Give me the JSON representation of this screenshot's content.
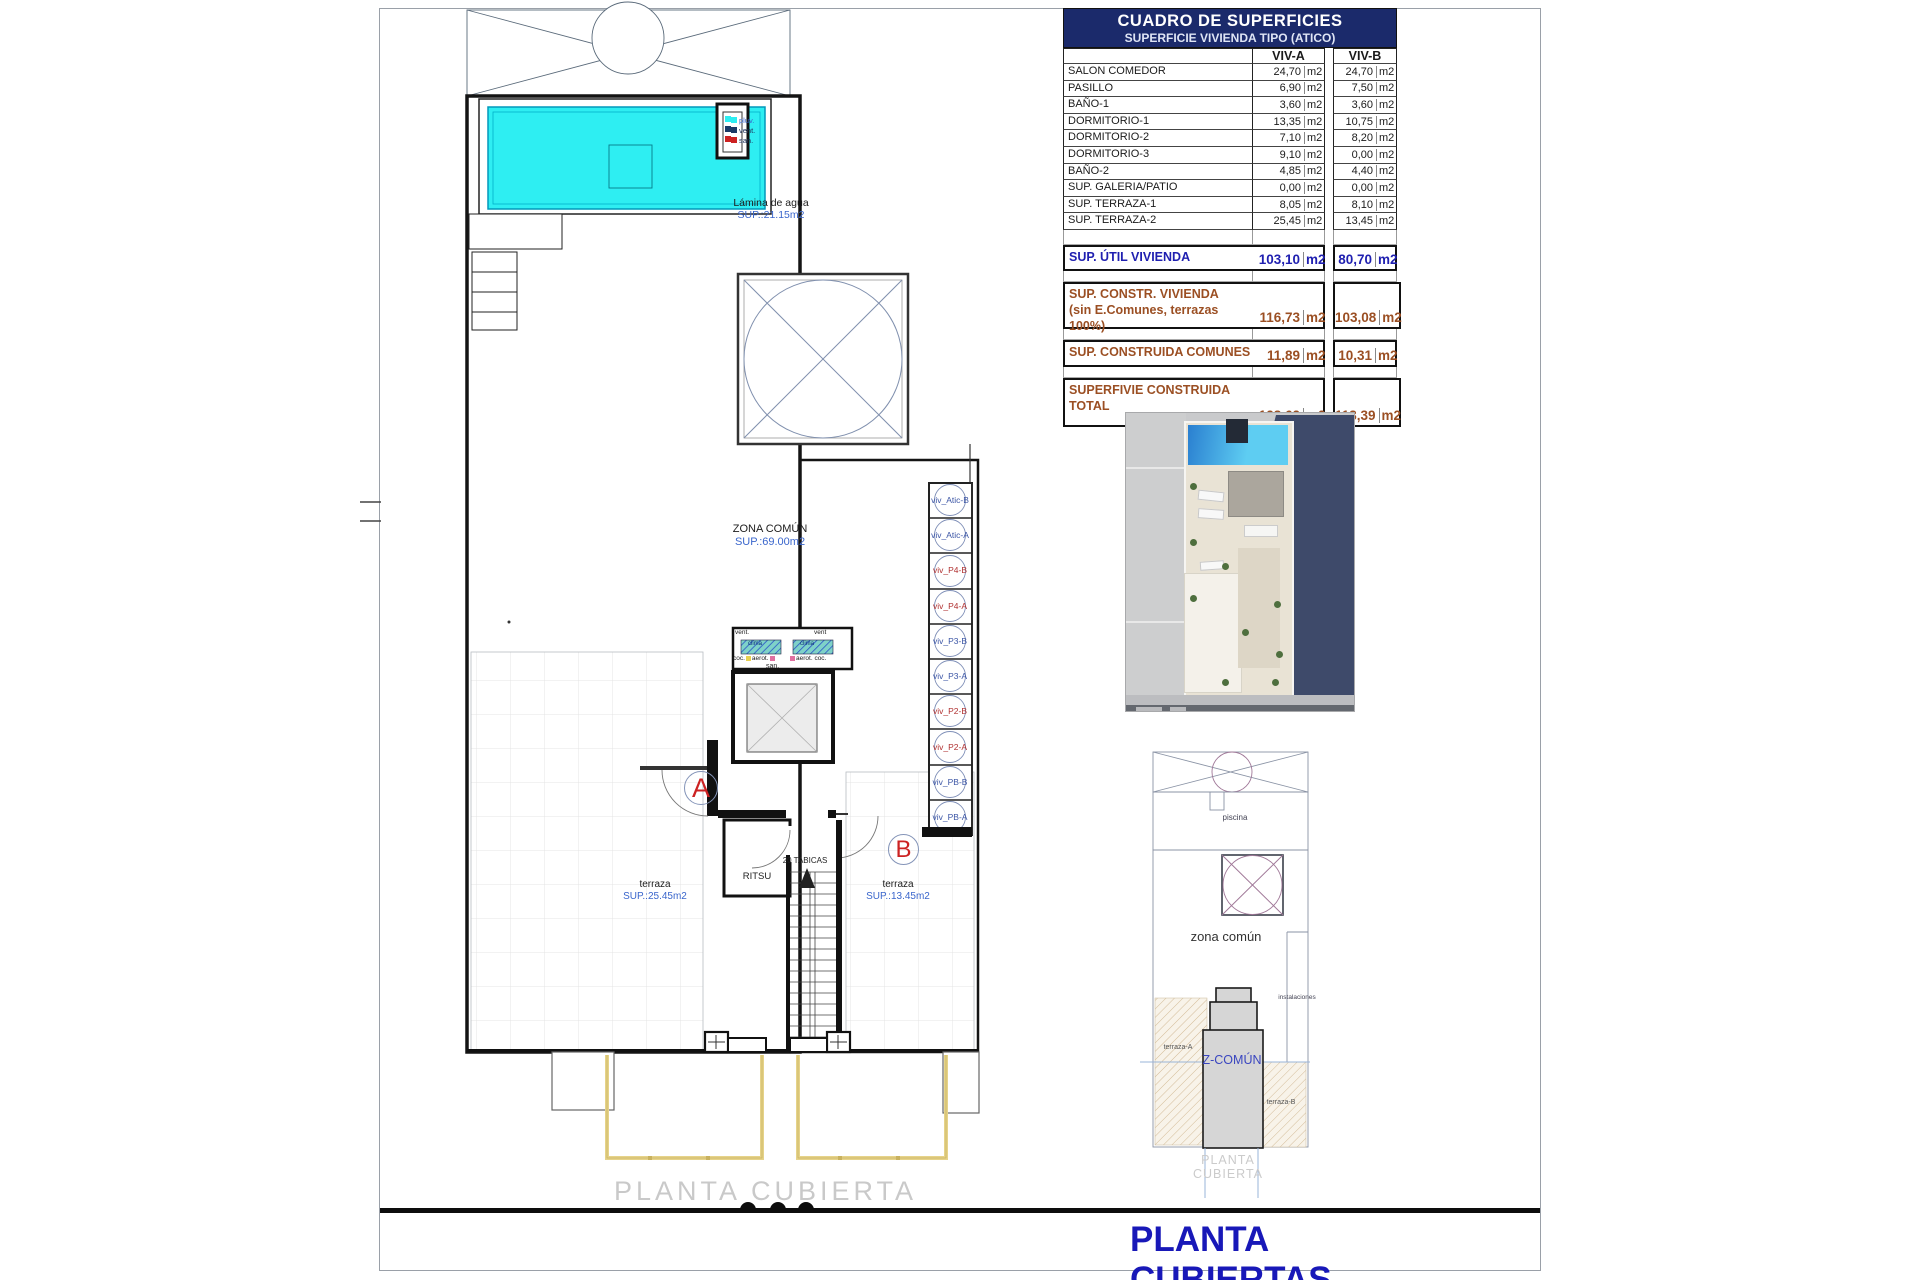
{
  "sheet": {
    "plan_caption": "PLANTA CUBIERTA",
    "sheet_title": "PLANTA CUBIERTAS"
  },
  "table": {
    "title": "CUADRO DE SUPERFICIES",
    "subtitle": "SUPERFICIE VIVIENDA TIPO  (ATICO)",
    "col_a": "VIV-A",
    "col_b": "VIV-B",
    "unit": "m2",
    "rows": [
      {
        "label": "SALON COMEDOR",
        "a": "24,70",
        "b": "24,70"
      },
      {
        "label": "PASILLO",
        "a": "6,90",
        "b": "7,50"
      },
      {
        "label": "BAÑO-1",
        "a": "3,60",
        "b": "3,60"
      },
      {
        "label": "DORMITORIO-1",
        "a": "13,35",
        "b": "10,75"
      },
      {
        "label": "DORMITORIO-2",
        "a": "7,10",
        "b": "8,20"
      },
      {
        "label": "DORMITORIO-3",
        "a": "9,10",
        "b": "0,00"
      },
      {
        "label": "BAÑO-2",
        "a": "4,85",
        "b": "4,40"
      },
      {
        "label": "SUP. GALERIA/PATIO",
        "a": "0,00",
        "b": "0,00"
      },
      {
        "label": "SUP. TERRAZA-1",
        "a": "8,05",
        "b": "8,10"
      },
      {
        "label": "SUP. TERRAZA-2",
        "a": "25,45",
        "b": "13,45"
      }
    ],
    "summary": [
      {
        "label": "SUP. ÚTIL VIVIENDA",
        "label2": "",
        "a": "103,10",
        "b": "80,70"
      },
      {
        "label": "SUP. CONSTR. VIVIENDA",
        "label2": "(sin E.Comunes, terrazas 100%)",
        "a": "116,73",
        "b": "103,08"
      },
      {
        "label": "SUP. CONSTRUIDA COMUNES",
        "label2": "",
        "a": "11,89",
        "b": "10,31"
      },
      {
        "label": "SUPERFIVIE CONSTRUIDA",
        "label2": "TOTAL",
        "a": "128,62",
        "b": "113,39"
      }
    ]
  },
  "plan": {
    "pool": {
      "label": "Lámina de agua",
      "sup": "SUP.:21.15m2"
    },
    "zona_comun": {
      "label": "ZONA COMÚN",
      "sup": "SUP.:69.00m2"
    },
    "terraza_a": {
      "label": "terraza",
      "sup": "SUP.:25.45m2"
    },
    "terraza_b": {
      "label": "terraza",
      "sup": "SUP.:13.45m2"
    },
    "marker_a": "A",
    "marker_b": "B",
    "stairs": {
      "ritsu": "RITSU",
      "tabicas": "20 TABICAS"
    },
    "shaft_legend": {
      "pluv": "pluv.",
      "vent": "vent.",
      "san": "san."
    },
    "equipment": {
      "vent_left": "vent.",
      "vent_right": "vent",
      "clima_left": "clima",
      "clima_right": "clima",
      "aerot_left": "aerot.",
      "aerot_right": "aerot.",
      "coc_left": "coc.",
      "coc_right": "coc.",
      "san": "san."
    }
  },
  "strip": {
    "items": [
      {
        "label": "viv_Atic-B",
        "color": "#3b55a5"
      },
      {
        "label": "viv_Atic-A",
        "color": "#3b55a5"
      },
      {
        "label": "viv_P4-B",
        "color": "#b03030"
      },
      {
        "label": "viv_P4-A",
        "color": "#b03030"
      },
      {
        "label": "viv_P3-B",
        "color": "#3b55a5"
      },
      {
        "label": "viv_P3-A",
        "color": "#3b55a5"
      },
      {
        "label": "viv_P2-B",
        "color": "#b03030"
      },
      {
        "label": "viv_P2-A",
        "color": "#b03030"
      },
      {
        "label": "viv_PB-B",
        "color": "#3b55a5"
      },
      {
        "label": "viv_PB-A",
        "color": "#3b55a5"
      }
    ]
  },
  "mini_plan": {
    "piscina": "piscina",
    "zona_comun": "zona común",
    "z_comun": "Z-COMÚN",
    "instalaciones": "instalaciones",
    "terraza_a": "terraza-A",
    "terraza_b": "terraza-B",
    "caption": "PLANTA CUBIERTA"
  },
  "colors": {
    "accent_blue": "#1818b8",
    "table_header_bg": "#1b2a6b",
    "summary_blue": "#1f1fb0",
    "summary_brown": "#9b4f23",
    "pool_cyan": "#2eeef2",
    "railing_yellow": "#e6d38a"
  }
}
